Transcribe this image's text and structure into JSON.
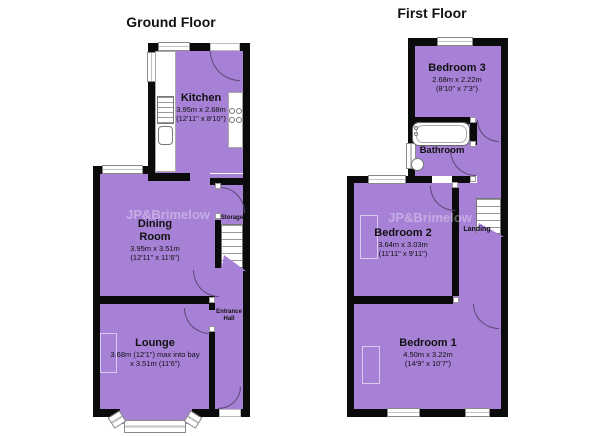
{
  "ground_floor": {
    "title": "Ground Floor",
    "rooms": {
      "kitchen": {
        "name": "Kitchen",
        "dims_m": "3.95m x 2.68m",
        "dims_ft": "(12'11\" x 8'10\")"
      },
      "dining": {
        "name_line1": "Dining",
        "name_line2": "Room",
        "dims_m": "3.95m x 3.51m",
        "dims_ft": "(12'11\" x 11'6\")"
      },
      "lounge": {
        "name": "Lounge",
        "dims_line1": "3.68m (12'1\") max into bay",
        "dims_line2": "x 3.51m (11'6\")"
      },
      "storage": {
        "name": "Storage"
      },
      "entrance_hall": {
        "name_line1": "Entrance",
        "name_line2": "Hall"
      }
    }
  },
  "first_floor": {
    "title": "First Floor",
    "rooms": {
      "bedroom3": {
        "name": "Bedroom 3",
        "dims_m": "2.68m x 2.22m",
        "dims_ft": "(8'10\" x 7'3\")"
      },
      "bathroom": {
        "name": "Bathroom"
      },
      "bedroom2": {
        "name": "Bedroom 2",
        "dims_m": "3.64m x 3.03m",
        "dims_ft": "(11'11\" x 9'11\")"
      },
      "landing": {
        "name": "Landing"
      },
      "bedroom1": {
        "name": "Bedroom 1",
        "dims_m": "4.50m x 3.22m",
        "dims_ft": "(14'9\" x 10'7\")"
      }
    }
  },
  "watermark": {
    "text": "JP&Brimelow"
  },
  "colors": {
    "room_fill": "#a681d6",
    "wall": "#0b0b0b",
    "background": "#ffffff"
  }
}
